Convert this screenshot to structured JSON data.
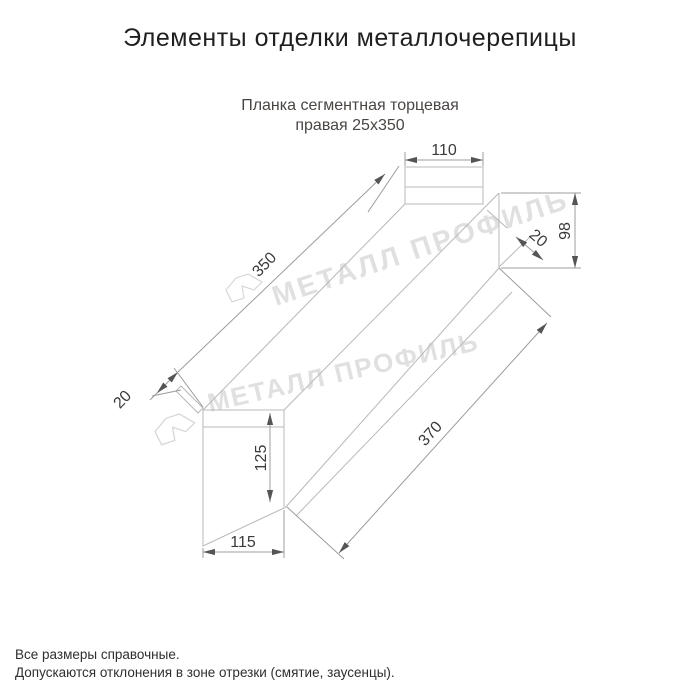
{
  "page": {
    "title": "Элементы отделки металлочерепицы",
    "subtitle_line1": "Планка сегментная торцевая",
    "subtitle_line2": "правая 25x350"
  },
  "watermark": {
    "text": "МЕТАЛЛ ПРОФИЛЬ"
  },
  "dimensions": {
    "top_flange_width": "110",
    "right_end_height": "98",
    "right_hem": "20",
    "top_edge_length": "350",
    "left_hem": "20",
    "bottom_edge_length": "370",
    "left_end_height": "125",
    "left_end_width": "115"
  },
  "footer": {
    "line1": "Все размеры справочные.",
    "line2": "Допускаются отклонения в зоне отрезки (смятие, заусенцы)."
  },
  "colors": {
    "title_text": "#1f1f1f",
    "subtitle_text": "#4a4644",
    "part_line": "#b8b8b8",
    "dimension_line": "#9c9c9c",
    "dimension_text": "#3a3a3a",
    "watermark": "#c6c6c6",
    "background": "#ffffff"
  }
}
